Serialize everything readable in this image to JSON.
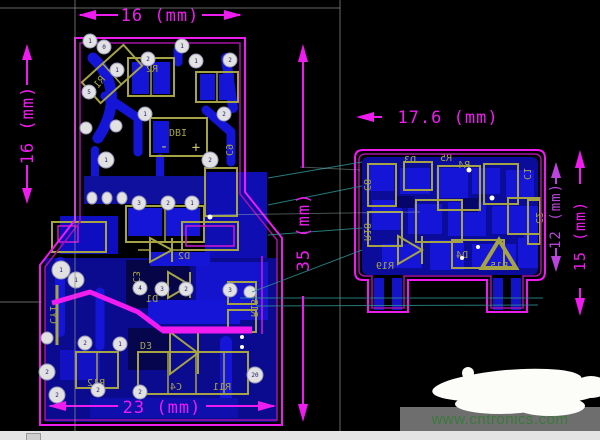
{
  "view": {
    "background": "#000000"
  },
  "dimensions": {
    "left_board_top": "16 (mm)",
    "left_board_side": "16 (mm)",
    "left_board_height": "35 (mm)",
    "left_board_bottom": "23 (mm)",
    "right_board_top": "17.6 (mm)",
    "right_board_body": "12 (mm)",
    "right_board_full": "15 (mm)"
  },
  "left_board": {
    "labels": {
      "r1": "R1",
      "r2": "R2",
      "db1": "DBI",
      "db1_minus": "-",
      "db1_plus": "+",
      "c9": "C9",
      "d2": "D2",
      "c3": "C3",
      "d1": "D1",
      "d3": "D3",
      "r12": "R12",
      "r13": "R13",
      "c4": "C4",
      "r11": "R11",
      "cy1": "CY1"
    },
    "pad_numbers": [
      "1",
      "0",
      "1",
      "2",
      "1",
      "1",
      "2",
      "5",
      "1",
      "2",
      "1",
      "2",
      "3",
      "2",
      "1",
      "1",
      "4",
      "3",
      "2",
      "3",
      "2",
      "1",
      "2",
      "2",
      "20",
      "2",
      "2",
      "1"
    ]
  },
  "right_board": {
    "labels": {
      "c8": "C8",
      "r18": "R18",
      "d3": "D3",
      "r4": "R4",
      "r5": "R5",
      "c1": "C1",
      "c2": "C2",
      "d4": "D4",
      "r19": "R19",
      "r15": "R15"
    }
  },
  "watermark": {
    "text": "www.cntronics.com"
  },
  "colors": {
    "outline": "#ee1cee",
    "outline_inner": "#a812a8",
    "copper": "#1515d8",
    "copper_dark": "#0b0b90",
    "silk": "#a6a345",
    "dimension": "#ee1cee",
    "dimension_alt": "#bb44dd",
    "ratsnest": "#2d8f8f",
    "pad": "#e2e2e2",
    "watermark_green": "#3a7a3a",
    "status_bar": "#e4e4e4",
    "watermark_band": "#6e6e6e"
  }
}
